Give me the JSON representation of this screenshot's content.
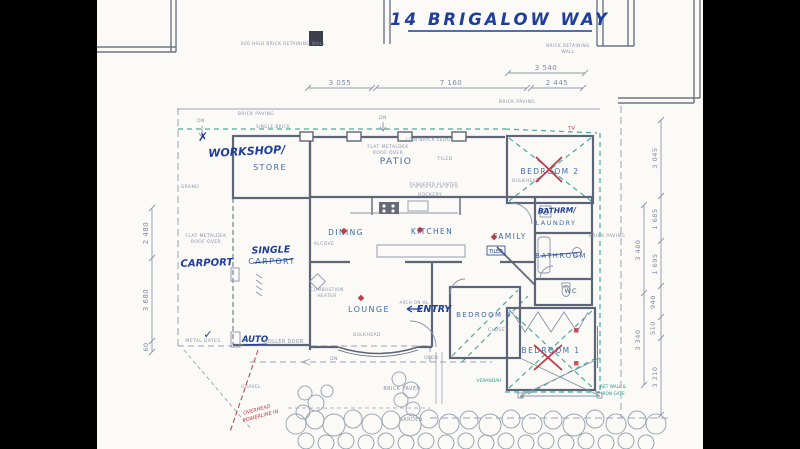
{
  "title": {
    "text": "14 BRIGALOW WAY"
  },
  "rooms": {
    "workshop_hw": "WORKSHOP/",
    "store": "STORE",
    "patio": "PATIO",
    "bedroom2": "BEDROOM 2",
    "bathrm_hw": "BATHRM/",
    "laundry": "LAUNDRY",
    "dining": "DINING",
    "kitchen": "KITCHEN",
    "family": "FAMILY",
    "bathroom": "BATHROOM",
    "wc": "WC",
    "carport_hw": "CARPORT",
    "single_hw": "SINGLE",
    "carport_pr": "CARPORT",
    "lounge": "LOUNGE",
    "entry_hw": "ENTRY",
    "bedroom3": "BEDROOM 3",
    "bedroom1": "BEDROOM 1"
  },
  "dims": {
    "top": [
      "3 055",
      "7 160",
      "3 540",
      "2 445"
    ],
    "left": [
      "2 480",
      "3 680",
      "60"
    ],
    "right_outer": [
      "3 045",
      "1 685",
      "1 695",
      "940",
      "510",
      "3 210"
    ],
    "right_inner": [
      "3 480",
      "3 340"
    ]
  },
  "notes": {
    "retaining_top": "600 HIGH BRICK RETAINING WALL",
    "retaining_right_1": "BRICK RETAINING",
    "retaining_right_2": "WALL",
    "brick_paving": "BRICK PAVING",
    "single_brick": "SINGLE BRICK",
    "flat_roof_1": "FLAT METALDEK",
    "flat_roof_2": "ROOF OVER",
    "low_ledge": "LOW BRICK LEDGE",
    "tiled": "TILED",
    "rockery": "ROCKERY",
    "planter": "RENDERED PLANTER",
    "grano": "GRANO",
    "alcove": "ALCOVE",
    "combustion_1": "COMBUSTION",
    "combustion_2": "HEATER",
    "bulkhead": "BULKHEAD",
    "closet": "CLOSET",
    "arch": "ARCH ON HL",
    "dn": "DN",
    "metal_gates": "METAL GATES",
    "roller_door": "ROLLER DOOR",
    "auto": "AUTO",
    "open": "OPEN",
    "brick_paved": "BRICK PAVED",
    "garden": "GARDEN",
    "verandah": "VERANDAH",
    "gravel": "GRAVEL",
    "powerline_1": "OVERHEAD",
    "powerline_2": "POWERLINE IN",
    "gate_note_1": "RET WALL &",
    "gate_note_2": "IRON GATE",
    "tv": "TV"
  },
  "marks": {
    "check": "✓",
    "cross": "✗"
  },
  "colors": {
    "paper": "#fbfaf7",
    "hand_ink": "#1e3d9c",
    "print_ink": "#3f6cab",
    "wall": "#5d6578",
    "dim": "#7f8ca3",
    "red": "#c0394a",
    "teal": "#2a9d8f"
  }
}
